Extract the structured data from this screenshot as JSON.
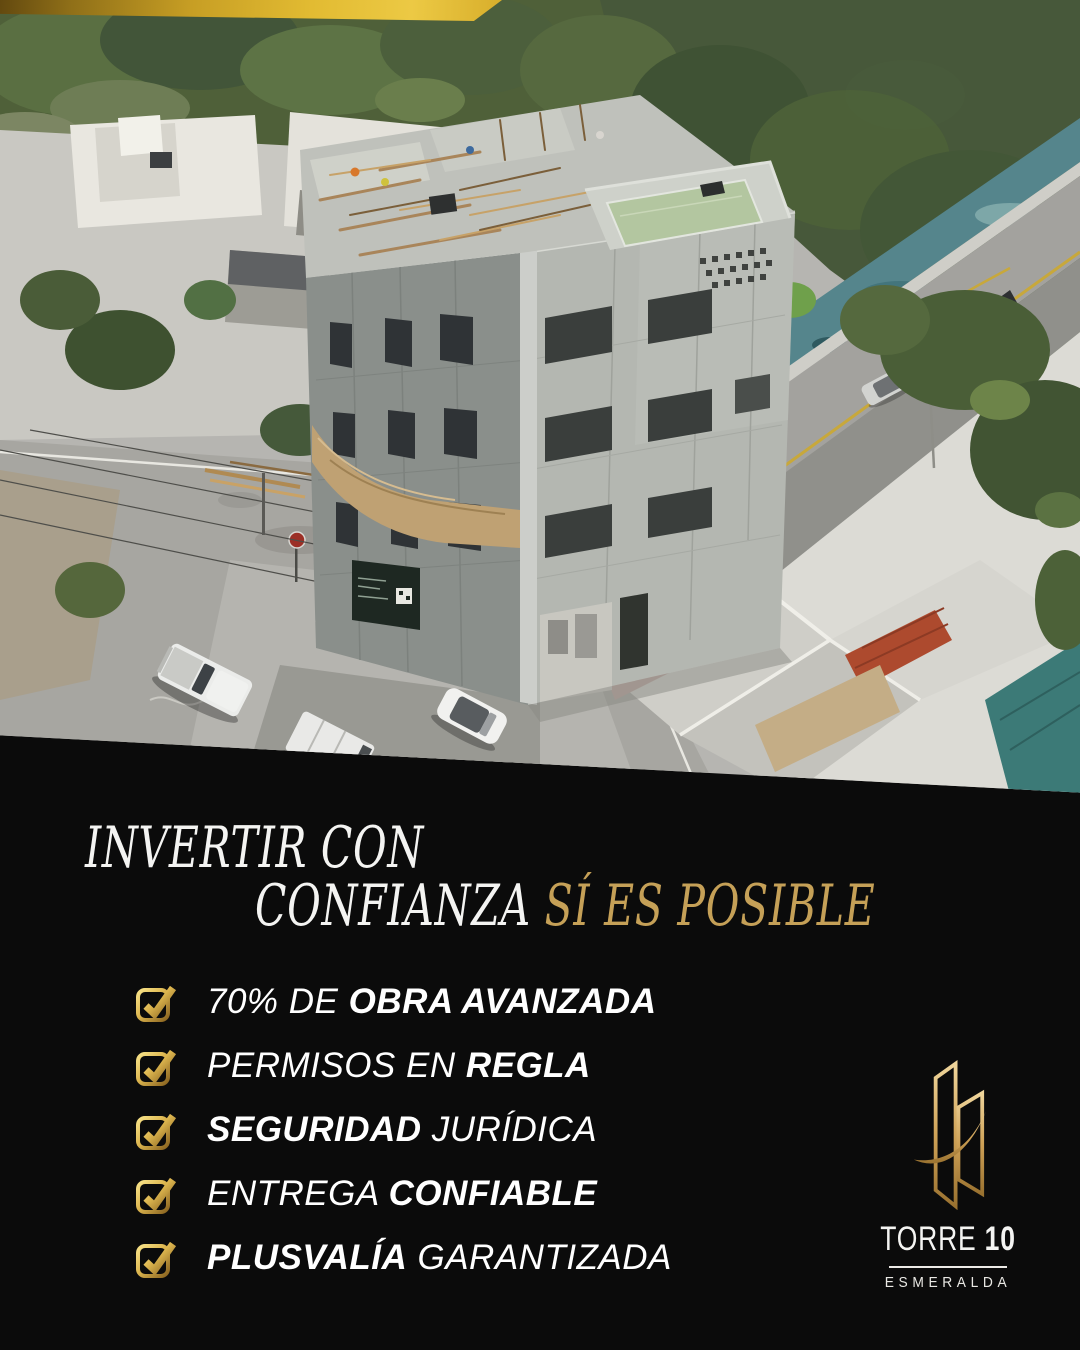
{
  "page": {
    "background": "#0b0b0b"
  },
  "ribbon": {
    "gradient_start": "#63490f",
    "gradient_end": "#e9c63e"
  },
  "headline": {
    "line1": "INVERTIR CON",
    "line2_white": "CONFIANZA",
    "line2_gold": "SÍ ES POSIBLE",
    "gold_color": "#c5a057"
  },
  "checklist": {
    "icon": "gold-checked-checkbox-icon",
    "items": [
      {
        "segments": [
          {
            "text": "70% DE ",
            "bold": false
          },
          {
            "text": "OBRA AVANZADA",
            "bold": true
          }
        ]
      },
      {
        "segments": [
          {
            "text": "PERMISOS EN ",
            "bold": false
          },
          {
            "text": "REGLA",
            "bold": true
          }
        ]
      },
      {
        "segments": [
          {
            "text": "SEGURIDAD",
            "bold": true
          },
          {
            "text": " JURÍDICA",
            "bold": false
          }
        ]
      },
      {
        "segments": [
          {
            "text": "ENTREGA ",
            "bold": false
          },
          {
            "text": "CONFIABLE",
            "bold": true
          }
        ]
      },
      {
        "segments": [
          {
            "text": "PLUSVALÍA",
            "bold": true
          },
          {
            "text": " GARANTIZADA",
            "bold": false
          }
        ]
      }
    ]
  },
  "brand": {
    "name_regular": "TORRE",
    "name_bold": "10",
    "subtitle": "ESMERALDA",
    "emblem": "gold-twin-towers-swoosh-logo",
    "gold": "#d2a75c"
  }
}
